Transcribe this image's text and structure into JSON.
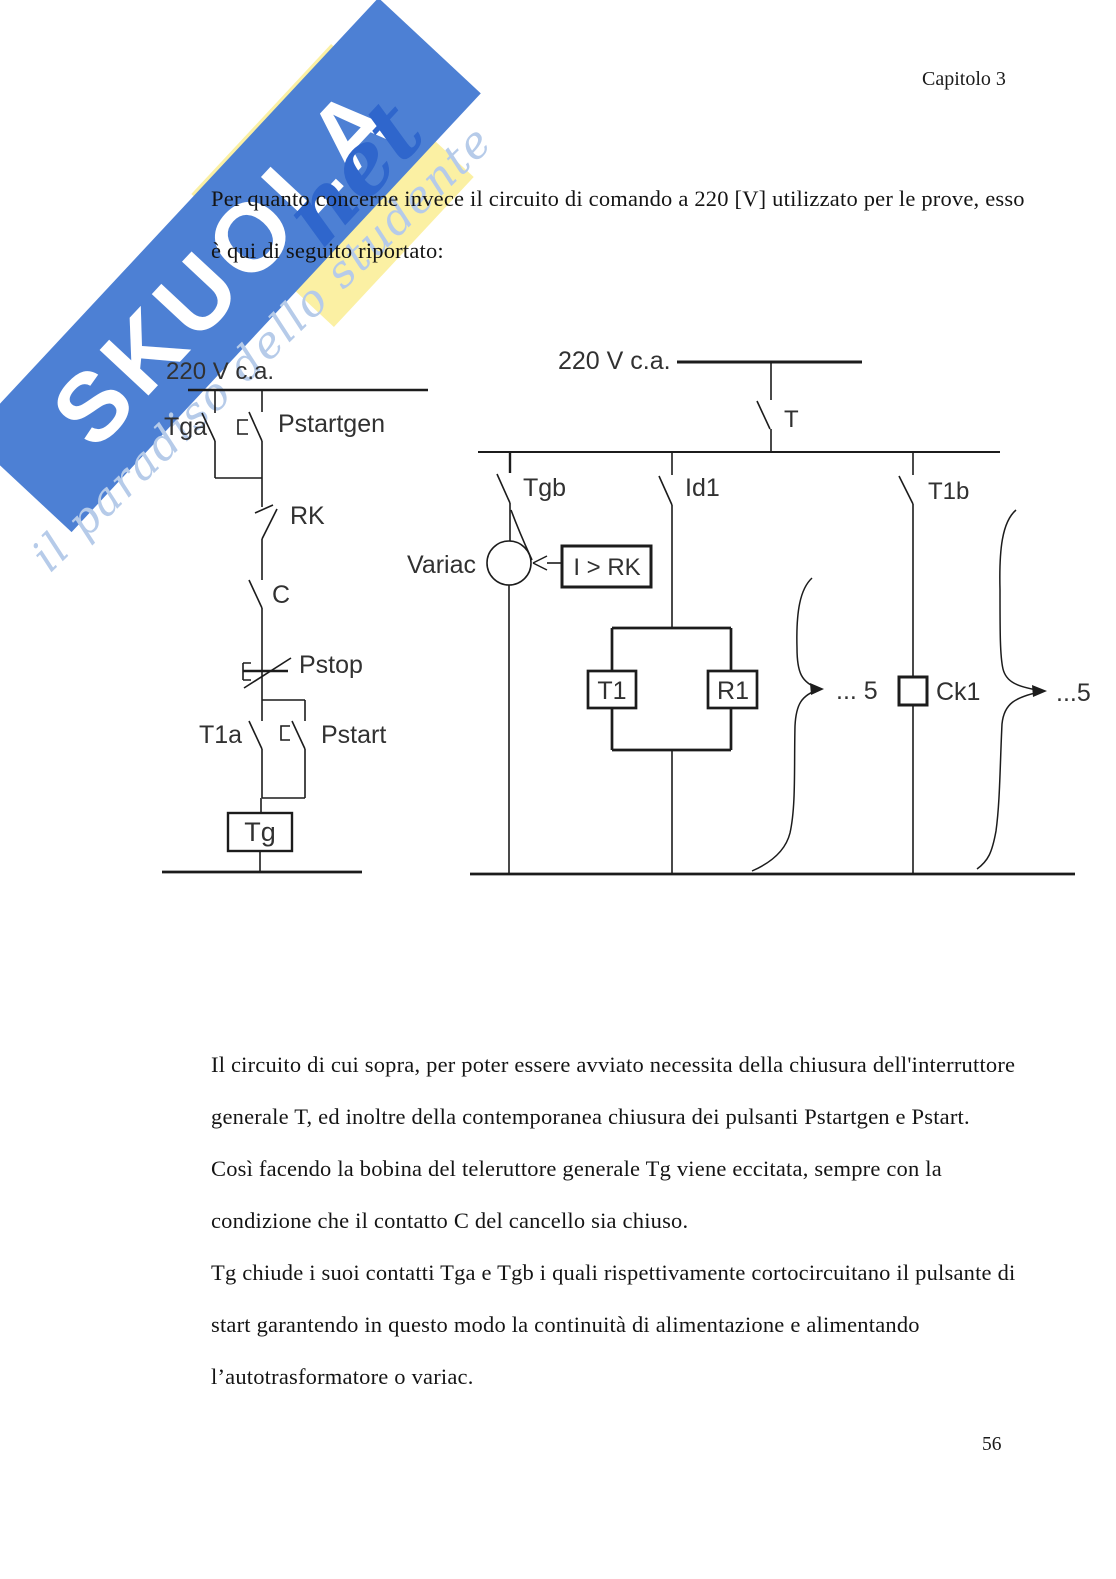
{
  "header": {
    "chapter": "Capitolo 3"
  },
  "footer": {
    "page_number": "56"
  },
  "watermark": {
    "brand": "SKUOLA",
    "brand_suffix": "net",
    "tagline": "il paradiso dello studente"
  },
  "intro": {
    "line1": "Per quanto concerne invece il circuito di comando a 220 [V] utilizzato per le prove, esso",
    "line2": "è qui di seguito riportato:"
  },
  "body": {
    "lines": [
      "Il circuito di cui sopra, per poter essere avviato necessita della chiusura dell'interruttore",
      "generale T, ed inoltre della contemporanea chiusura dei pulsanti Pstartgen e Pstart.",
      "Così facendo la bobina del teleruttore generale Tg viene eccitata, sempre con la",
      "condizione che il contatto C del cancello sia chiuso.",
      "Tg chiude i suoi contatti Tga e Tgb i quali rispettivamente cortocircuitano il pulsante di",
      "start garantendo in questo modo la continuità di alimentazione e alimentando",
      "l’autotrasformatore o variac."
    ]
  },
  "diagram": {
    "left": {
      "supply": "220 V  c.a.",
      "tga": "Tga",
      "pstartgen": "Pstartgen",
      "rk": "RK",
      "c": "C",
      "pstop": "Pstop",
      "t1a": "T1a",
      "pstart": "Pstart",
      "tg_coil": "Tg"
    },
    "right": {
      "supply": "220 V c.a.",
      "t": "T",
      "tgb": "Tgb",
      "id1": "Id1",
      "t1b": "T1b",
      "variac": "Variac",
      "overcurrent": "I > RK",
      "t1": "T1",
      "r1": "R1",
      "ck1": "Ck1",
      "ellipsis5_left": "... 5",
      "ellipsis5_right": "...5"
    }
  },
  "colors": {
    "band_blue": "#4d80d4",
    "net_blue": "#2f66cc",
    "tagline_blue": "#b6cbe9",
    "watermark_yellow": "#fbf0a3"
  }
}
